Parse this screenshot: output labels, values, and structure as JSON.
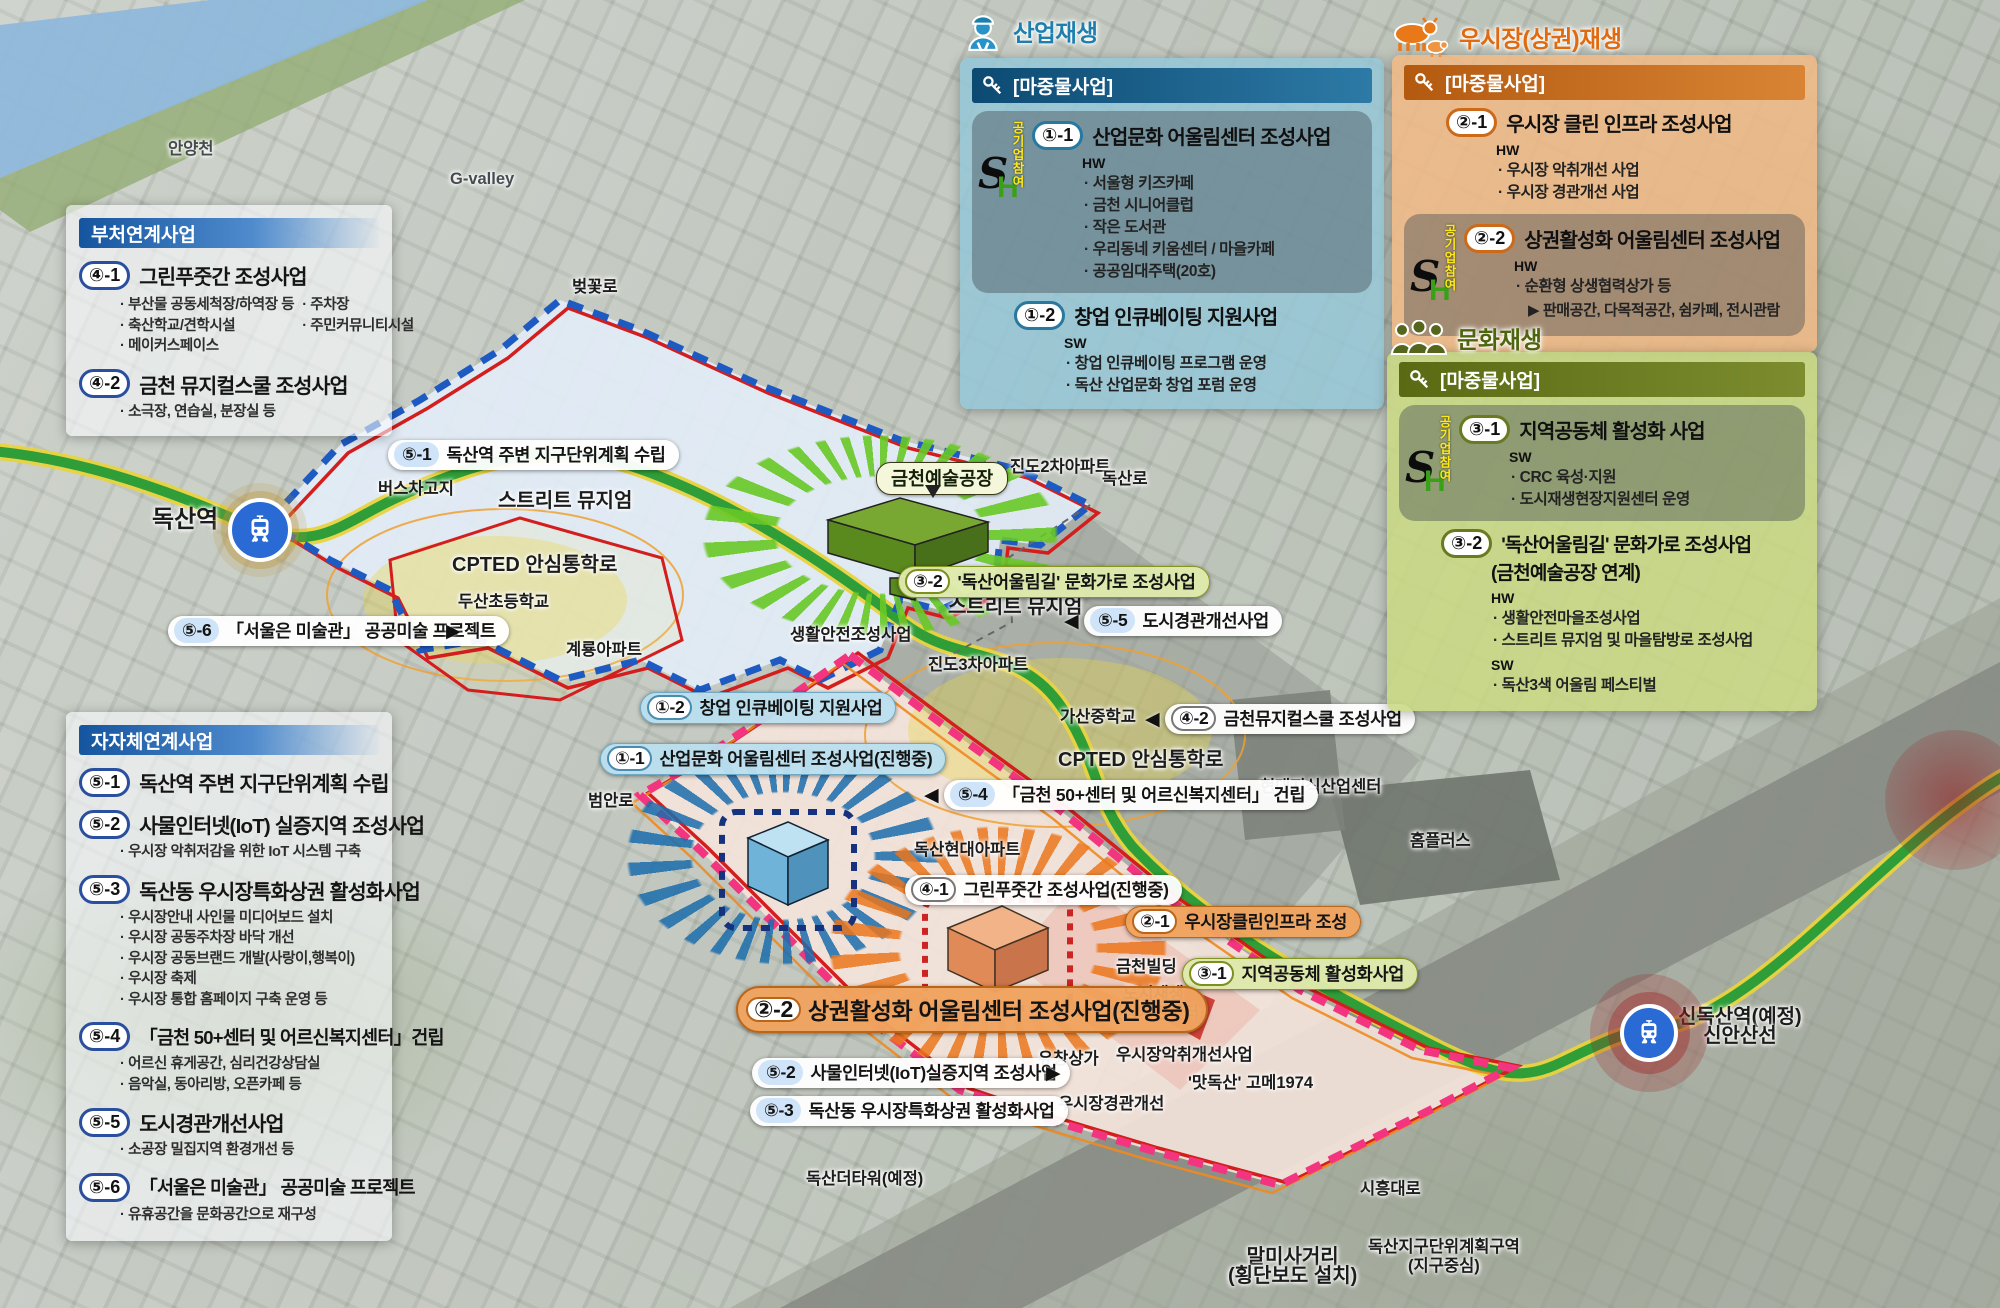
{
  "sh": {
    "s": "S",
    "h": "H",
    "participation": "공기업참여"
  },
  "panels": {
    "ministry": {
      "header": "부처연계사업",
      "items": [
        {
          "badge": "④-1",
          "title": "그린푸줏간 조성사업",
          "bullets_left": [
            "부산물 공동세척장/하역장 등",
            "축산학교/견학시설",
            "메이커스페이스"
          ],
          "bullets_right": [
            "주차장",
            "주민커뮤니티시설"
          ]
        },
        {
          "badge": "④-2",
          "title": "금천 뮤지컬스쿨 조성사업",
          "bullets": [
            "소극장, 연습실, 분장실 등"
          ]
        }
      ]
    },
    "industry": {
      "title": "산업재생",
      "subheader": "[마중물사업]",
      "items": [
        {
          "badge": "①-1",
          "title": "산업문화 어울림센터 조성사업",
          "type": "HW",
          "bullets": [
            "서울형 키즈카페",
            "금천 시니어클럽",
            "작은 도서관",
            "우리동네 키움센터 / 마을카페",
            "공공임대주택(20호)"
          ]
        },
        {
          "badge": "①-2",
          "title": "창업 인큐베이팅 지원사업",
          "type": "SW",
          "bullets": [
            "창업 인큐베이팅 프로그램 운영",
            "독산 산업문화 창업 포럼 운영"
          ]
        }
      ]
    },
    "market": {
      "title": "우시장(상권)재생",
      "subheader": "[마중물사업]",
      "items": [
        {
          "badge": "②-1",
          "title": "우시장 클린 인프라 조성사업",
          "type": "HW",
          "bullets": [
            "우시장 악취개선 사업",
            "우시장 경관개선 사업"
          ]
        },
        {
          "badge": "②-2",
          "title": "상권활성화 어울림센터 조성사업",
          "type": "HW",
          "bullets": [
            "순환형 상생협력상가 등"
          ],
          "note": "▶ 판매공간, 다목적공간, 쉼카페, 전시관람"
        }
      ]
    },
    "culture": {
      "title": "문화재생",
      "subheader": "[마중물사업]",
      "items": [
        {
          "badge": "③-1",
          "title": "지역공동체 활성화 사업",
          "type": "SW",
          "bullets": [
            "CRC 육성·지원",
            "도시재생현장지원센터 운영"
          ]
        },
        {
          "badge": "③-2",
          "title": "'독산어울림길' 문화가로 조성사업",
          "title2": "(금천예술공장 연계)",
          "type": "HW",
          "bullets": [
            "생활안전마을조성사업",
            "스트리트 뮤지엄 및 마을탐방로 조성사업"
          ],
          "type2": "SW",
          "bullets2": [
            "독산3색 어울림 페스티벌"
          ]
        }
      ]
    },
    "local": {
      "header": "자자체연계사업",
      "items": [
        {
          "badge": "⑤-1",
          "title": "독산역 주변 지구단위계획 수립",
          "bullets": []
        },
        {
          "badge": "⑤-2",
          "title": "사물인터넷(IoT) 실증지역 조성사업",
          "bullets": [
            "우시장 악취저감을 위한 IoT 시스템 구축"
          ]
        },
        {
          "badge": "⑤-3",
          "title": "독산동 우시장특화상권 활성화사업",
          "bullets": [
            "우시장안내 사인물 미디어보드 설치",
            "우시장 공동주차장 바닥 개선",
            "우시장 공동브랜드 개발(사랑이,행복이)",
            "우시장 축제",
            "우시장 통합 홈페이지 구축 운영 등"
          ]
        },
        {
          "badge": "⑤-4",
          "title": "「금천 50+센터 및 어르신복지센터」건립",
          "bullets": [
            "어르신 휴게공간, 심리건강상담실",
            "음악실, 동아리방, 오픈카페 등"
          ]
        },
        {
          "badge": "⑤-5",
          "title": "도시경관개선사업",
          "bullets": [
            "소공장 밀집지역 환경개선 등"
          ]
        },
        {
          "badge": "⑤-6",
          "title": "「서울은 미술관」 공공미술 프로젝트",
          "bullets": [
            "유휴공간을 문화공간으로 재구성"
          ]
        }
      ]
    }
  },
  "map": {
    "bubble": {
      "text": "금천예술공장"
    },
    "pills": [
      {
        "badge": "⑤-1",
        "text": "독산역 주변 지구단위계획 수립"
      },
      {
        "badge": "⑤-6",
        "text": "「서울은 미술관」 공공미술 프로젝트"
      },
      {
        "badge": "③-2",
        "text": "'독산어울림길' 문화가로 조성사업"
      },
      {
        "badge": "⑤-5",
        "text": "도시경관개선사업"
      },
      {
        "badge": "①-2",
        "text": "창업 인큐베이팅 지원사업"
      },
      {
        "badge": "①-1",
        "text": "산업문화 어울림센터 조성사업(진행중)"
      },
      {
        "badge": "④-2",
        "text": "금천뮤지컬스쿨 조성사업"
      },
      {
        "badge": "⑤-4",
        "text": "「금천 50+센터 및 어르신복지센터」 건립"
      },
      {
        "badge": "④-1",
        "text": "그린푸줏간 조성사업(진행중)"
      },
      {
        "badge": "②-1",
        "text": "우시장클린인프라 조성"
      },
      {
        "badge": "③-1",
        "text": "지역공동체 활성화사업"
      },
      {
        "badge": "②-2",
        "text": "상권활성화 어울림센터 조성사업(진행중)"
      },
      {
        "badge": "⑤-2",
        "text": "사물인터넷(IoT)실증지역 조성사업"
      },
      {
        "badge": "⑤-3",
        "text": "독산동 우시장특화상권 활성화사업"
      }
    ],
    "arrows": [
      {
        "glyph": "▶"
      },
      {
        "glyph": "◀"
      },
      {
        "glyph": "◀"
      },
      {
        "glyph": "◀"
      },
      {
        "glyph": "▶"
      }
    ],
    "labels": [
      {
        "text": "안양천"
      },
      {
        "text": "G-valley"
      },
      {
        "text": "벚꽃로"
      },
      {
        "text": "버스차고지"
      },
      {
        "text": "스트리트 뮤지엄"
      },
      {
        "text": "CPTED 안심통학로"
      },
      {
        "text": "두산초등학교"
      },
      {
        "text": "계룡아파트"
      },
      {
        "text": "진도2차아파트"
      },
      {
        "text": "독산로"
      },
      {
        "text": "스트리트 뮤지엄"
      },
      {
        "text": "생활안전조성사업"
      },
      {
        "text": "진도3차아파트"
      },
      {
        "text": "가산중학교"
      },
      {
        "text": "CPTED 안심통학로"
      },
      {
        "text": "현대지식산업센터"
      },
      {
        "text": "독산현대아파트"
      },
      {
        "text": "범안로"
      },
      {
        "text": "금천빌딩"
      },
      {
        "text": "도시재생",
        "text2": "현장지원센터"
      },
      {
        "text": "유창상가"
      },
      {
        "text": "우시장악취개선사업"
      },
      {
        "text": "'맛독산' 고메1974"
      },
      {
        "text": "우시장경관개선"
      },
      {
        "text": "독산더타워(예정)"
      },
      {
        "text": "홈플러스"
      },
      {
        "text": "시흥대로"
      },
      {
        "text": "말미사거리",
        "text2": "(횡단보도 설치)"
      },
      {
        "text": "독산지구단위계획구역",
        "text2": "(지구중심)"
      },
      {
        "text": "독산역"
      },
      {
        "text": "신독산역(예정)",
        "text2": "신안산선"
      }
    ]
  }
}
